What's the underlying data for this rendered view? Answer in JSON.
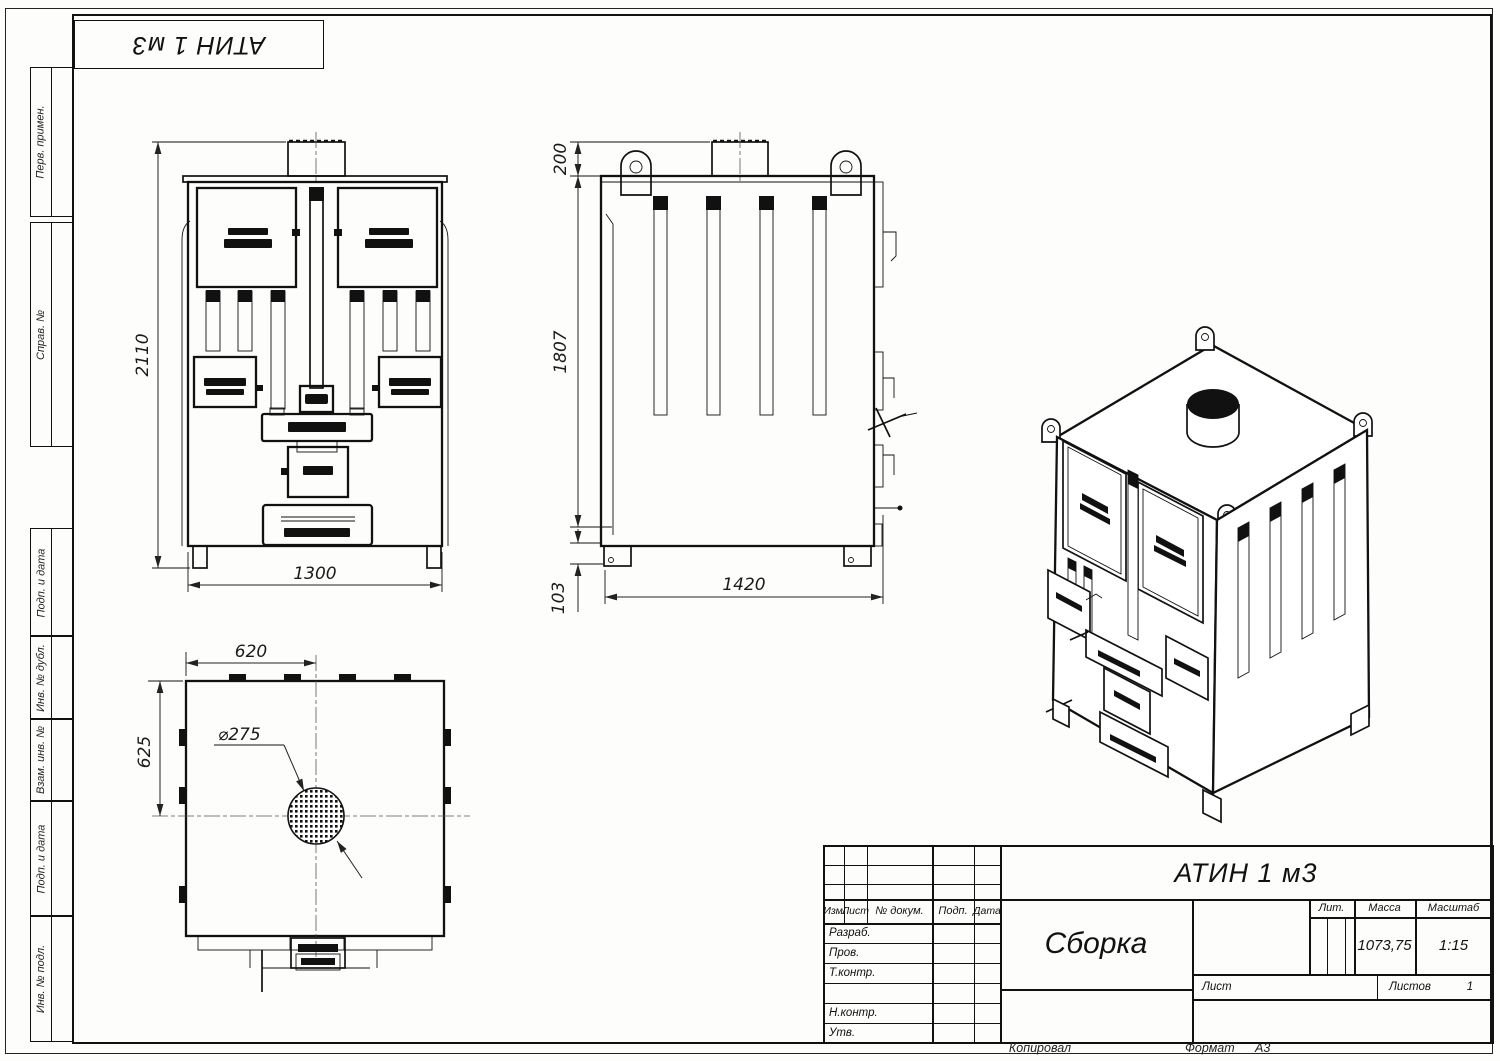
{
  "page": {
    "designation_flipped": "АТИН 1 м3"
  },
  "sidebar": {
    "items": [
      {
        "label": "Перв. примен."
      },
      {
        "label": "Справ. №"
      },
      {
        "label": "Подп. и дата"
      },
      {
        "label": "Инв. № дубл."
      },
      {
        "label": "Взам. инв. №"
      },
      {
        "label": "Подп. и дата"
      },
      {
        "label": "Инв. № подл."
      }
    ]
  },
  "views": {
    "front": {
      "dims": {
        "height": "2110",
        "width": "1300"
      }
    },
    "side": {
      "dims": {
        "top": "200",
        "height": "1807",
        "base": "103",
        "depth": "1420"
      }
    },
    "top": {
      "dims": {
        "width": "620",
        "depth": "625",
        "chimney_dia": "⌀275"
      }
    }
  },
  "title_block": {
    "designation": "АТИН 1 м3",
    "doc_name": "Сборка",
    "columns": {
      "izm": "Изм.",
      "list": "Лист",
      "doc_num": "№ докум.",
      "podp": "Подп.",
      "data": "Дата"
    },
    "roles": {
      "razrab": "Разраб.",
      "prov": "Пров.",
      "tkontr": "Т.контр.",
      "nkontr": "Н.контр.",
      "utv": "Утв."
    },
    "props": {
      "lit_label": "Лит.",
      "mass_label": "Масса",
      "scale_label": "Масштаб",
      "mass_value": "1073,75",
      "scale_value": "1:15"
    },
    "sheets": {
      "list_label": "Лист",
      "listov_label": "Листов",
      "listov_value": "1"
    }
  },
  "footer": {
    "kopiroval": "Копировал",
    "format_label": "Формат",
    "format_value": "А3"
  }
}
